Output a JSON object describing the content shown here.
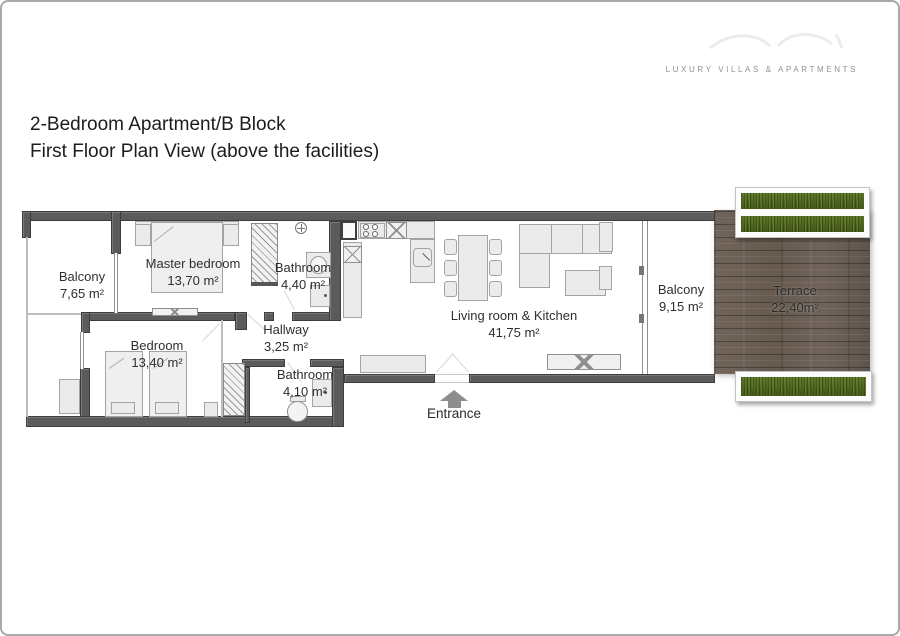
{
  "brand": {
    "tagline": "LUXURY VILLAS & APARTMENTS"
  },
  "header": {
    "title_line1": "2-Bedroom Apartment/B Block",
    "title_line2": "First Floor Plan View (above the facilities)"
  },
  "rooms": [
    {
      "id": "balcony-left",
      "name": "Balcony",
      "area": "7,65 m²"
    },
    {
      "id": "master-bedroom",
      "name": "Master bedroom",
      "area": "13,70 m²"
    },
    {
      "id": "bathroom-top",
      "name": "Bathroom",
      "area": "4,40 m²"
    },
    {
      "id": "bedroom",
      "name": "Bedroom",
      "area": "13,40 m²"
    },
    {
      "id": "hallway",
      "name": "Hallway",
      "area": "3,25 m²"
    },
    {
      "id": "bathroom-bottom",
      "name": "Bathroom",
      "area": "4,10 m²"
    },
    {
      "id": "living-kitchen",
      "name": "Living room & Kitchen",
      "area": "41,75 m²"
    },
    {
      "id": "balcony-right",
      "name": "Balcony",
      "area": "9,15 m²"
    },
    {
      "id": "terrace",
      "name": "Terrace",
      "area": "22,40m²"
    }
  ],
  "entrance": {
    "label": "Entrance"
  },
  "colors": {
    "wall": "#5b5b5b",
    "wall_edge": "#3d3d3d",
    "furniture_fill": "#ebebeb",
    "furniture_border": "#a3a3a3",
    "wood_base": "#6b5e53",
    "grass": "#4f661d",
    "label_text": "#2f2f2f"
  }
}
